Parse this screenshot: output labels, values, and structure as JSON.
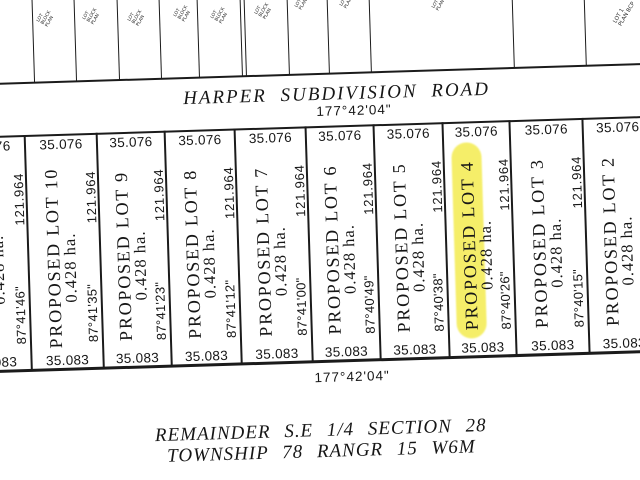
{
  "colors": {
    "ink": "#1b1b1b",
    "highlight": "#f3eb49"
  },
  "road": {
    "name": "HARPER SUBDIVISION ROAD",
    "bearing": "177°42'04\""
  },
  "lot_block": {
    "lots": [
      {
        "name": "PROPOSED LOT 10",
        "area": "0.428 ha.",
        "top": "35.076",
        "bottom": "35.083",
        "highlighted": false
      },
      {
        "name": "PROPOSED LOT 9",
        "area": "0.428 ha.",
        "top": "35.076",
        "bottom": "35.083",
        "highlighted": false
      },
      {
        "name": "PROPOSED LOT 8",
        "area": "0.428 ha.",
        "top": "35.076",
        "bottom": "35.083",
        "highlighted": false
      },
      {
        "name": "PROPOSED LOT 7",
        "area": "0.428 ha.",
        "top": "35.076",
        "bottom": "35.083",
        "highlighted": false
      },
      {
        "name": "PROPOSED LOT 6",
        "area": "0.428 ha.",
        "top": "35.076",
        "bottom": "35.083",
        "highlighted": false
      },
      {
        "name": "PROPOSED LOT 5",
        "area": "0.428 ha.",
        "top": "35.076",
        "bottom": "35.083",
        "highlighted": false
      },
      {
        "name": "PROPOSED LOT 4",
        "area": "0.428 ha.",
        "top": "35.076",
        "bottom": "35.083",
        "highlighted": true
      },
      {
        "name": "PROPOSED LOT 3",
        "area": "0.428 ha.",
        "top": "35.076",
        "bottom": "35.083",
        "highlighted": false
      },
      {
        "name": "PROPOSED LOT 2",
        "area": "0.428 ha.",
        "top": "35.076",
        "bottom": "35.083",
        "highlighted": false
      }
    ],
    "partial_lot": {
      "area": "0.428 ha.",
      "top": "35.076",
      "bottom": "35.083"
    },
    "boundaries": [
      {
        "length": "121.964",
        "bearing": "87°41'46\""
      },
      {
        "length": "121.964",
        "bearing": "87°41'35\""
      },
      {
        "length": "121.964",
        "bearing": "87°41'23\""
      },
      {
        "length": "121.964",
        "bearing": "87°41'12\""
      },
      {
        "length": "121.964",
        "bearing": "87°41'00\""
      },
      {
        "length": "121.964",
        "bearing": "87°40'49\""
      },
      {
        "length": "121.964",
        "bearing": "87°40'38\""
      },
      {
        "length": "121.964",
        "bearing": "87°40'26\""
      },
      {
        "length": "121.964",
        "bearing": "87°40'15\""
      }
    ]
  },
  "bottom": {
    "bearing": "177°42'04\"",
    "remainder_line1": "REMAINDER  S.E  1/4  SECTION  28",
    "remainder_line2": "TOWNSHIP  78  RANGR  15  W6M"
  },
  "top_strip": {
    "labels": [
      "LOT\nBLOCK\nPLAN",
      "LOT\nBLOCK\nPLAN",
      "LOT\nBLOCK\nPLAN",
      "LOT\nBLOCK\nPLAN",
      "LOT\nBLOCK\nPLAN",
      "LOT\nBLOCK\nPLAN",
      "LOT\nPLAN",
      "LOT\nPLAN",
      "LOT\nPLAN",
      "LOT 1\nPLAN BCP"
    ]
  }
}
